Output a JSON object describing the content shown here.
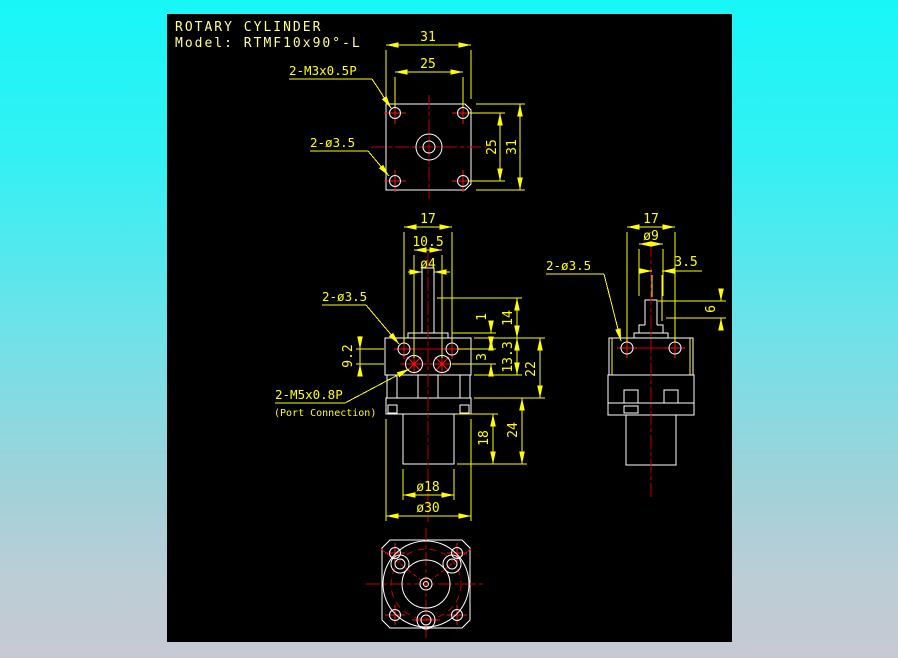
{
  "title": {
    "line1": "ROTARY CYLINDER",
    "line2": "Model: RTMF10x90°-L"
  },
  "colors": {
    "background_top": "#18f6f8",
    "background_bottom": "#c6c9d3",
    "canvas": "#000000",
    "geometry_lines": "#ffffff",
    "dimension_lines": "#ffff00",
    "centerlines": "#c40000",
    "hole_marks": "#ff1111",
    "title_text": "#ffff8c"
  },
  "top_view": {
    "dim_width_outer": "31",
    "dim_width_inner": "25",
    "dim_height_inner": "25",
    "dim_height_outer": "31",
    "label_thread_holes": "2-M3x0.5P",
    "label_through_holes": "2-ø3.5"
  },
  "front_view": {
    "dim_hole_spacing": "17",
    "dim_port_spacing": "10.5",
    "dim_shaft_dia": "ø4",
    "label_through_holes": "2-ø3.5",
    "dim_port_offset": "9.2",
    "label_ports": "2-M5x0.8P",
    "label_ports_note": "(Port Connection)",
    "dim_plate_thickness": "1",
    "dim_shaft_height": "14",
    "dim_row_gap": "3",
    "dim_body_height": "13.3",
    "dim_upper_height": "22",
    "dim_cyl_height": "18",
    "dim_lower_height": "24",
    "dim_cyl_dia": "ø18",
    "dim_flange_dia": "ø30"
  },
  "side_view": {
    "dim_hole_spacing": "17",
    "dim_boss_dia": "ø9",
    "dim_offset": "3.5",
    "dim_boss_height": "6",
    "label_through_holes": "2-ø3.5"
  }
}
